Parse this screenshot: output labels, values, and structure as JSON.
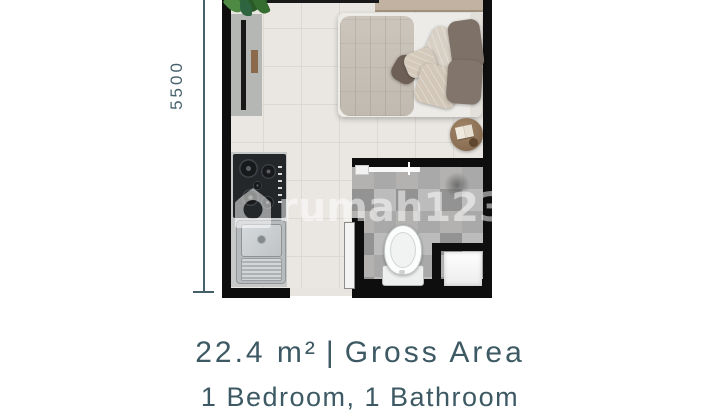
{
  "dimension": {
    "label": "5500",
    "color": "#47626d"
  },
  "watermark": {
    "brand": "rumah123",
    "color": "rgba(255,255,255,0.52)"
  },
  "footer": {
    "area_value": "22.4 m²",
    "separator": "|",
    "area_label": "Gross Area",
    "rooms": "1 Bedroom, 1 Bathroom",
    "text_color": "#3d5963"
  },
  "floorplan": {
    "wall_color": "#0e0e0e",
    "floor_color": "#eae7e2",
    "rooms": {
      "bedroom": "bedroom",
      "kitchen": "kitchen",
      "bathroom": "bathroom"
    },
    "fixtures": [
      "bed",
      "pillows",
      "headboard",
      "tv-console",
      "plant",
      "side-table",
      "stove",
      "sink",
      "toilet",
      "shower-tray",
      "shower-door",
      "sliding-door"
    ]
  }
}
